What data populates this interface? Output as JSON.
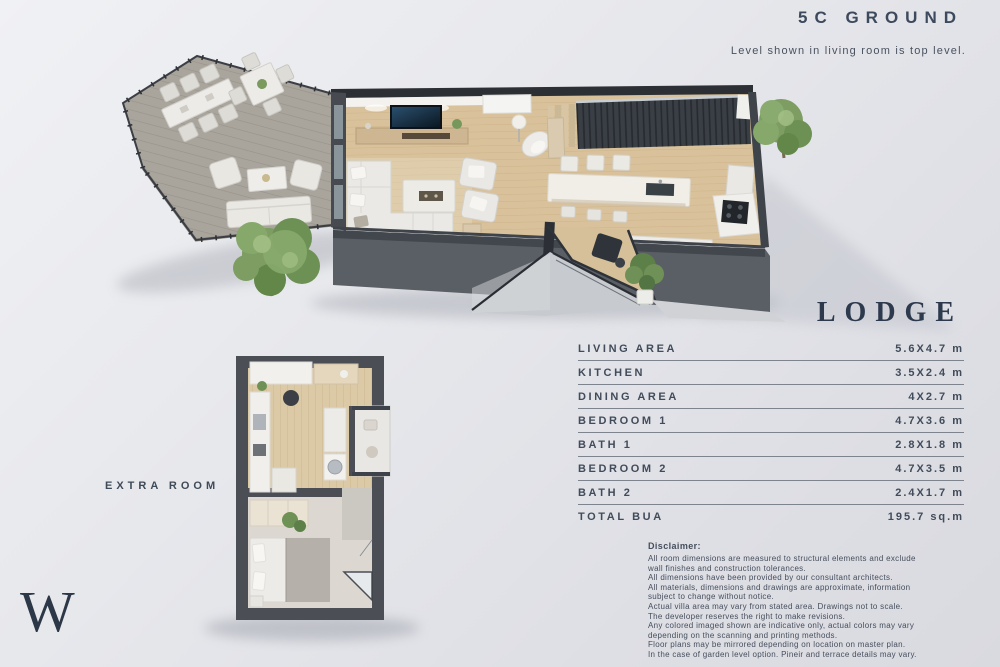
{
  "header": {
    "title": "5C GROUND",
    "subtitle": "Level shown in living room is top level."
  },
  "unit": {
    "name": "LODGE"
  },
  "extra_room": {
    "label": "EXTRA ROOM"
  },
  "table": {
    "rows": [
      {
        "label": "LIVING AREA",
        "value": "5.6X4.7 m"
      },
      {
        "label": "KITCHEN",
        "value": "3.5X2.4 m"
      },
      {
        "label": "DINING AREA",
        "value": "4X2.7 m"
      },
      {
        "label": "BEDROOM 1",
        "value": "4.7X3.6 m"
      },
      {
        "label": "BATH 1",
        "value": "2.8X1.8 m"
      },
      {
        "label": "BEDROOM 2",
        "value": "4.7X3.5 m"
      },
      {
        "label": "BATH 2",
        "value": "2.4X1.7 m"
      },
      {
        "label": "TOTAL BUA",
        "value": "195.7 sq.m"
      }
    ]
  },
  "disclaimer": {
    "heading": "Disclaimer:",
    "lines": [
      "All room dimensions are measured to structural elements and exclude",
      "wall finishes and construction tolerances.",
      "All dimensions have been provided by our consultant architects.",
      "All materials, dimensions and drawings are approximate, information",
      "subject to change without notice.",
      "Actual villa area may vary from stated area. Drawings not to scale.",
      "The developer reserves the right to make revisions.",
      "Any colored imaged shown are indicative only, actual colors may vary",
      "depending on the scanning and printing methods.",
      "Floor plans may be mirrored depending on location on master plan.",
      "In the case of garden level option. Pineir and terrace details may vary."
    ]
  },
  "logo": {
    "letter": "W"
  },
  "colors": {
    "text": "#3d4a5d",
    "background": "#e4e5ea",
    "wood_floor": "#d9c29b",
    "deck": "#a9a59d",
    "wall": "#4b4f55",
    "greenery": "#7d9d62"
  }
}
